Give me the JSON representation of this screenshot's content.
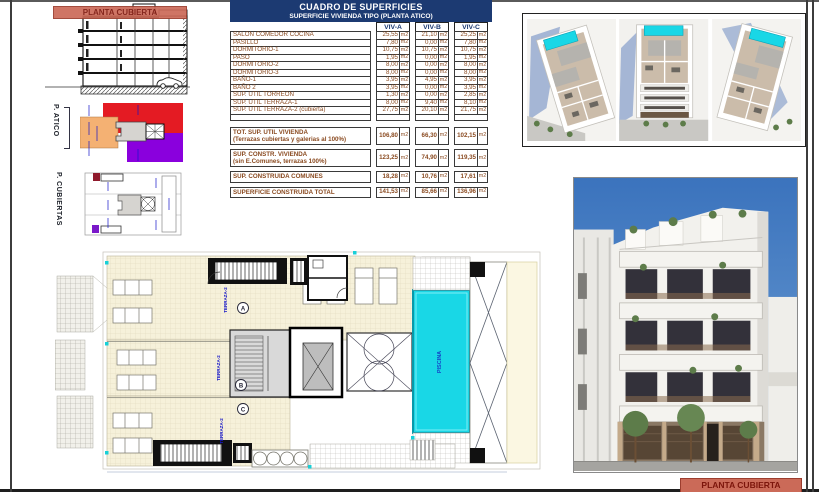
{
  "colors": {
    "navy": "#1c3a72",
    "tabletxt": "#8a4a20",
    "bannerbg": "#cb6a58",
    "bannertxt": "#7c150b",
    "red": "#e41b23",
    "purple": "#8a00dd",
    "orange": "#f4b173",
    "pool": "#19d7e6",
    "cream": "#f6f1da",
    "sky": "#4580c6",
    "shadow": "#8ba2cc"
  },
  "sheet": {
    "banner_top": "PLANTA CUBIERTA",
    "banner_bottom": "PLANTA CUBIERTA",
    "side_labels": {
      "atico": "P. ATICO",
      "cubiertas": "P. CUBIERTAS"
    }
  },
  "table": {
    "title": "CUADRO DE SUPERFICIES",
    "subtitle": "SUPERFICIE VIVIENDA TIPO  (PLANTA ATICO)",
    "columns": [
      "VIV-A",
      "VIV-B",
      "VIV-C"
    ],
    "unit": "m2",
    "rows": [
      {
        "label": "SALON COMEDOR COCINA",
        "a": "25,55",
        "b": "21,10",
        "c": "25,25"
      },
      {
        "label": "PASILLO",
        "a": "7,80",
        "b": "0,00",
        "c": "7,80"
      },
      {
        "label": "DORMITORIO-1",
        "a": "10,75",
        "b": "10,75",
        "c": "10,75"
      },
      {
        "label": "PASO",
        "a": "1,95",
        "b": "0,00",
        "c": "1,95"
      },
      {
        "label": "DORMITORIO-2",
        "a": "8,00",
        "b": "0,00",
        "c": "8,00"
      },
      {
        "label": "DORMITORIO-3",
        "a": "8,00",
        "b": "0,00",
        "c": "8,00"
      },
      {
        "label": "BAÑO-1",
        "a": "3,95",
        "b": "4,95",
        "c": "3,95"
      },
      {
        "label": "BAÑO 2",
        "a": "3,95",
        "b": "0,00",
        "c": "3,95"
      },
      {
        "label": "SUP. UTIL TORREON",
        "a": "1,30",
        "b": "0,00",
        "c": "2,85"
      },
      {
        "label": "SUP. UTIL TERRAZA-1",
        "a": "8,00",
        "b": "9,40",
        "c": "8,10"
      },
      {
        "label": "SUP. UTIL TERRAZA-2 (cubierta)",
        "a": "27,75",
        "b": "20,10",
        "c": "21,75"
      }
    ],
    "totals": [
      {
        "label": "TOT. SUP. UTIL VIVIENDA",
        "sublabel": "(Terrazas cubiertas y galerias al 100%)",
        "a": "106,80",
        "b": "66,30",
        "c": "102,15"
      },
      {
        "label": "SUP. CONSTR. VIVIENDA",
        "sublabel": "(sin E.Comunes, terrazas 100%)",
        "a": "123,25",
        "b": "74,90",
        "c": "119,35"
      },
      {
        "label": "SUP. CONSTRUIDA COMUNES",
        "a": "18,28",
        "b": "10,76",
        "c": "17,61"
      },
      {
        "label": "SUPERFICIE CONSTRUIDA TOTAL",
        "a": "141,53",
        "b": "85,66",
        "c": "136,96"
      }
    ]
  },
  "plan": {
    "terrace_label": "TERRAZA-2",
    "pool_label": "PISCINA",
    "unit_marks": [
      "A",
      "B",
      "C"
    ]
  }
}
